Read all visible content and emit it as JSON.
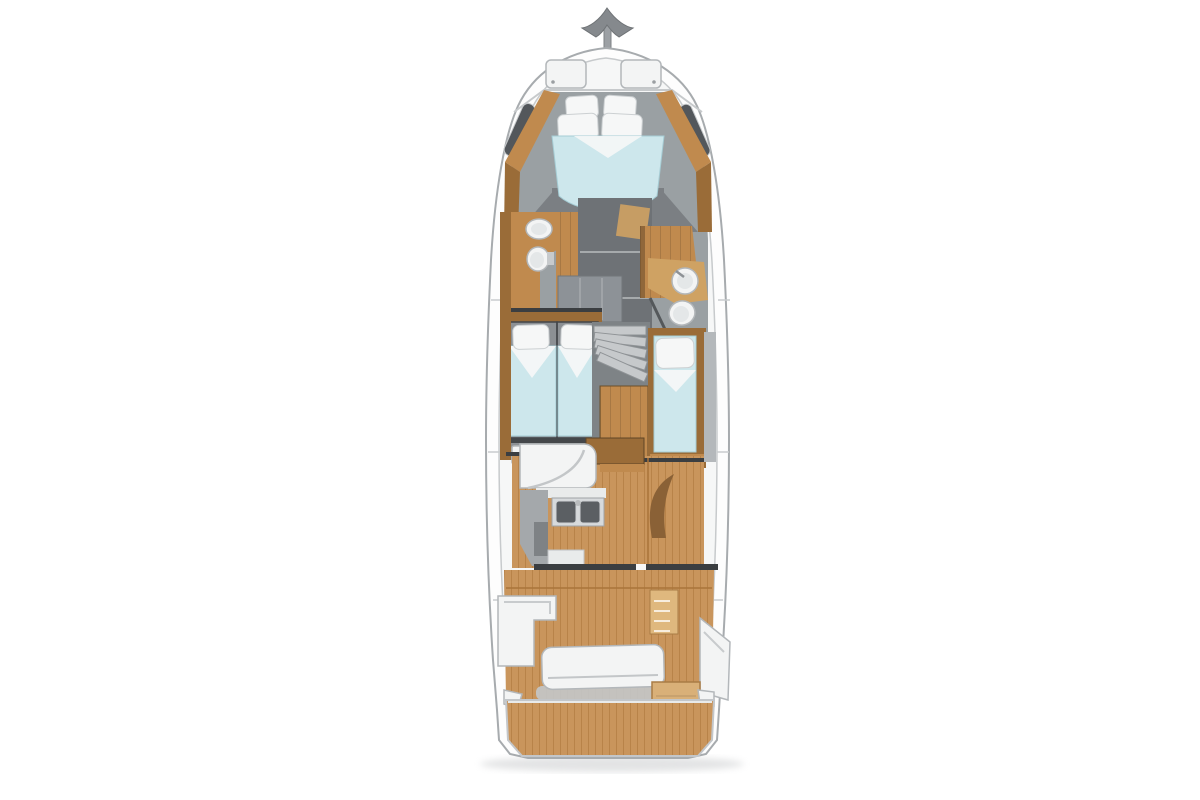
{
  "page": {
    "background": "#ffffff",
    "kind": "yacht-interior-deck-plan-top-view"
  },
  "colors": {
    "page_bg": "#ffffff",
    "hull_white": "#fdfdfd",
    "deck_white": "#f6f7f7",
    "hull_line": "#a7abae",
    "hull_line_soft": "#c7cacc",
    "interior_gray": "#9aa0a3",
    "interior_gray_dark": "#7b7f83",
    "corridor_gray": "#6e7276",
    "wood": "#c08a4e",
    "wood_dark": "#9a6c38",
    "wood_light": "#cfa263",
    "teak": "#c9955c",
    "teak_line": "#a9743a",
    "teak_light": "#dfb87e",
    "bed_blue": "#cde7ec",
    "bed_blue_edge": "#a5ccd4",
    "linen_white": "#f6f7f7",
    "fixture_white": "#f3f4f4",
    "fixture_stroke": "#b3b7ba",
    "bulkhead_dark": "#3b3e41",
    "metal_gray": "#9ca0a4",
    "cabinet_gray": "#8d9297",
    "shadow": "#aeb1b4"
  },
  "scene": {
    "vessel": "Motor yacht interior layout, overhead deck plan",
    "areas": [
      "bow anchor and pulpit rail",
      "foredeck hatches",
      "owner V-berth cabin",
      "port head with sink and toilet",
      "starboard head with sink and toilet",
      "port guest cabin with twin beds",
      "starboard single-berth cabin",
      "companionway winding stairs",
      "galley with double sink",
      "helm seat",
      "saloon teak sole",
      "cockpit with bench seating and steps",
      "transom locker",
      "swim platform"
    ],
    "counts": {
      "foredeck_hatches": 2,
      "v_berth_pillows": 4,
      "twin_beds": 2,
      "single_berths": 1,
      "heads": 2,
      "galley_sink_basins": 2
    }
  }
}
